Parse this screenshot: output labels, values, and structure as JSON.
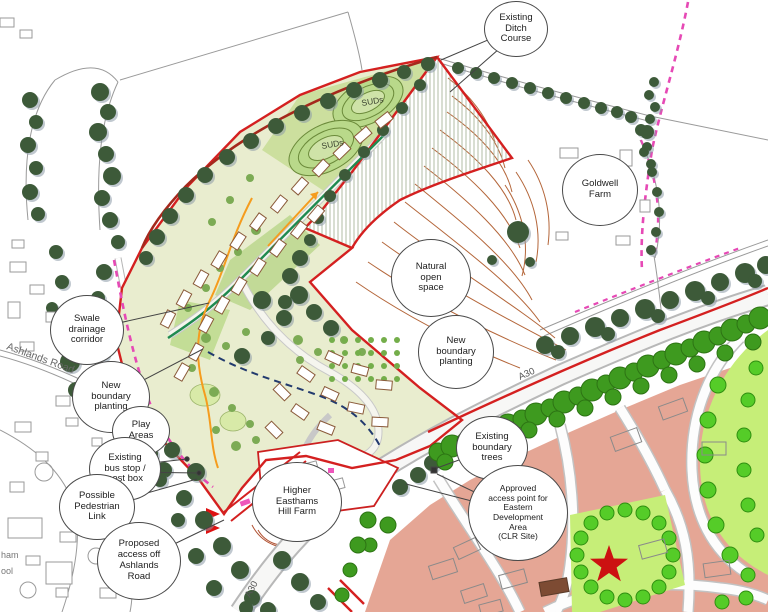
{
  "map": {
    "labels": {
      "suds_upper": "SUDs",
      "suds_lower": "SUDs",
      "ashlands_road": "Ashlands Road",
      "a30_upper": "A30",
      "a30_lower": "A30",
      "clipped_1": "ham",
      "clipped_2": "ool"
    },
    "callouts": [
      {
        "id": "existing-ditch-course",
        "text": "Existing\nDitch\nCourse"
      },
      {
        "id": "goldwell-farm",
        "text": "Goldwell\nFarm"
      },
      {
        "id": "natural-open-space",
        "text": "Natural\nopen\nspace"
      },
      {
        "id": "new-boundary-planting-east",
        "text": "New\nboundary\nplanting"
      },
      {
        "id": "swale-drainage-corridor",
        "text": "Swale\ndrainage\ncorridor"
      },
      {
        "id": "new-boundary-planting-west",
        "text": "New\nboundary\nplanting"
      },
      {
        "id": "play-areas",
        "text": "Play\nAreas"
      },
      {
        "id": "existing-bus-stop",
        "text": "Existing\nbus stop /\npost box"
      },
      {
        "id": "possible-pedestrian-link",
        "text": "Possible\nPedestrian\nLink"
      },
      {
        "id": "proposed-access",
        "text": "Proposed\naccess off\nAshlands\nRoad"
      },
      {
        "id": "higher-easthams-hill-farm",
        "text": "Higher\nEasthams\nHill Farm"
      },
      {
        "id": "existing-boundary-trees",
        "text": "Existing\nboundary\ntrees"
      },
      {
        "id": "approved-access-point",
        "text": "Approved\naccess point for\nEastern\nDevelopment\nArea\n(CLR Site)"
      }
    ],
    "colors": {
      "site_boundary_red": "#d42020",
      "contour_brown": "#b4663a",
      "dark_tree_green": "#3d5a39",
      "bright_tree_green": "#3e9a1f",
      "park_tree_green": "#55cc28",
      "clr_block_salmon": "#e5a695",
      "park_green": "#c6ee78",
      "route_magenta": "#e649b5",
      "swale_orange": "#f59c1e",
      "street_green": "#1f8a50",
      "path_navy": "#223a6e",
      "site_fill": "#e9edcf",
      "star_red": "#cc1111"
    }
  }
}
